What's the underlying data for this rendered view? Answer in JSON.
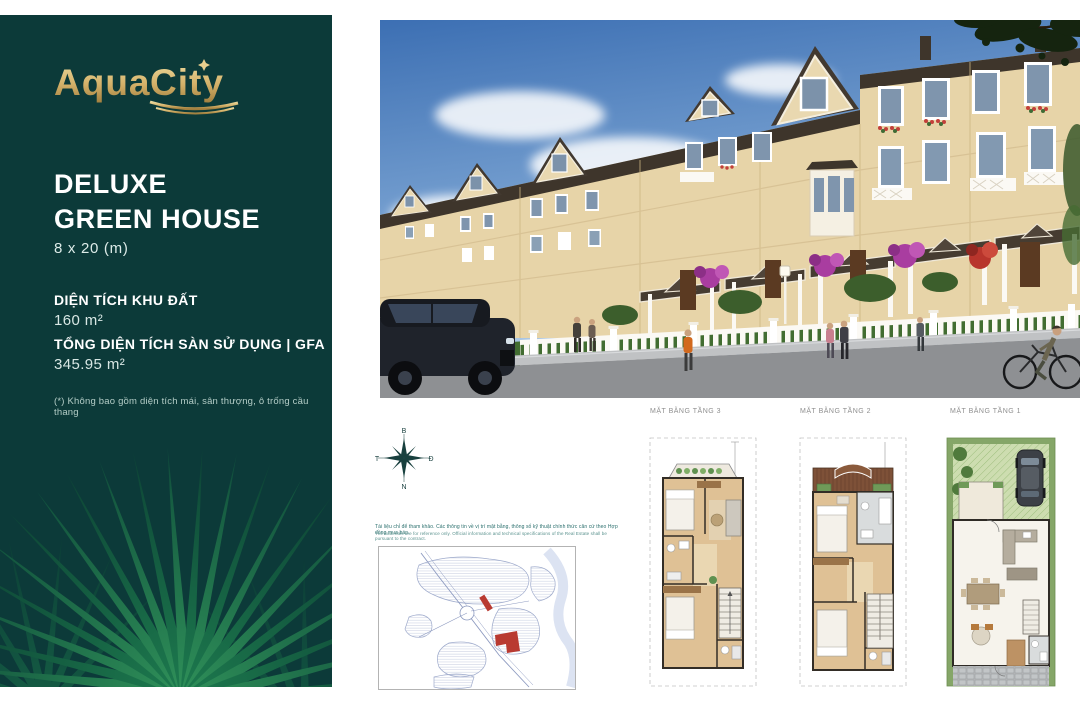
{
  "brand": {
    "logo_aqua": "Aqua",
    "logo_city": "City"
  },
  "sidebar": {
    "title_line1": "DELUXE",
    "title_line2": "GREEN HOUSE",
    "size": "8 x 20 (m)",
    "land_area_label": "DIỆN TÍCH KHU ĐẤT",
    "land_area_value": "160 m²",
    "gfa_label": "TỔNG DIỆN TÍCH SÀN SỬ DỤNG | GFA",
    "gfa_value": "345.95 m²",
    "footnote": "(*) Không bao gồm diện tích mái, sân thượng, ô trống cầu thang"
  },
  "floorplans": {
    "floor3_label": "MẶT BẰNG TẦNG 3",
    "floor2_label": "MẶT BẰNG TẦNG 2",
    "floor1_label": "MẶT BẰNG TẦNG 1"
  },
  "compass": {
    "north": "B",
    "east": "Đ",
    "south": "N",
    "west": "T"
  },
  "site_map": {
    "caption_line1": "Tài liệu chỉ để tham khảo. Các thông tin về vị trí mặt bằng, thông số kỹ thuật chính thức căn cứ theo Hợp đồng mua bán.",
    "caption_line2": "The materials are for reference only. Official information and technical specifications of the Real Estate shall be pursuant to the contract."
  },
  "colors": {
    "panel_teal": "#0c3a39",
    "logo_gold": "#d3b068",
    "accent_red": "#b93a31",
    "wall_cream": "#e7d4a8"
  }
}
